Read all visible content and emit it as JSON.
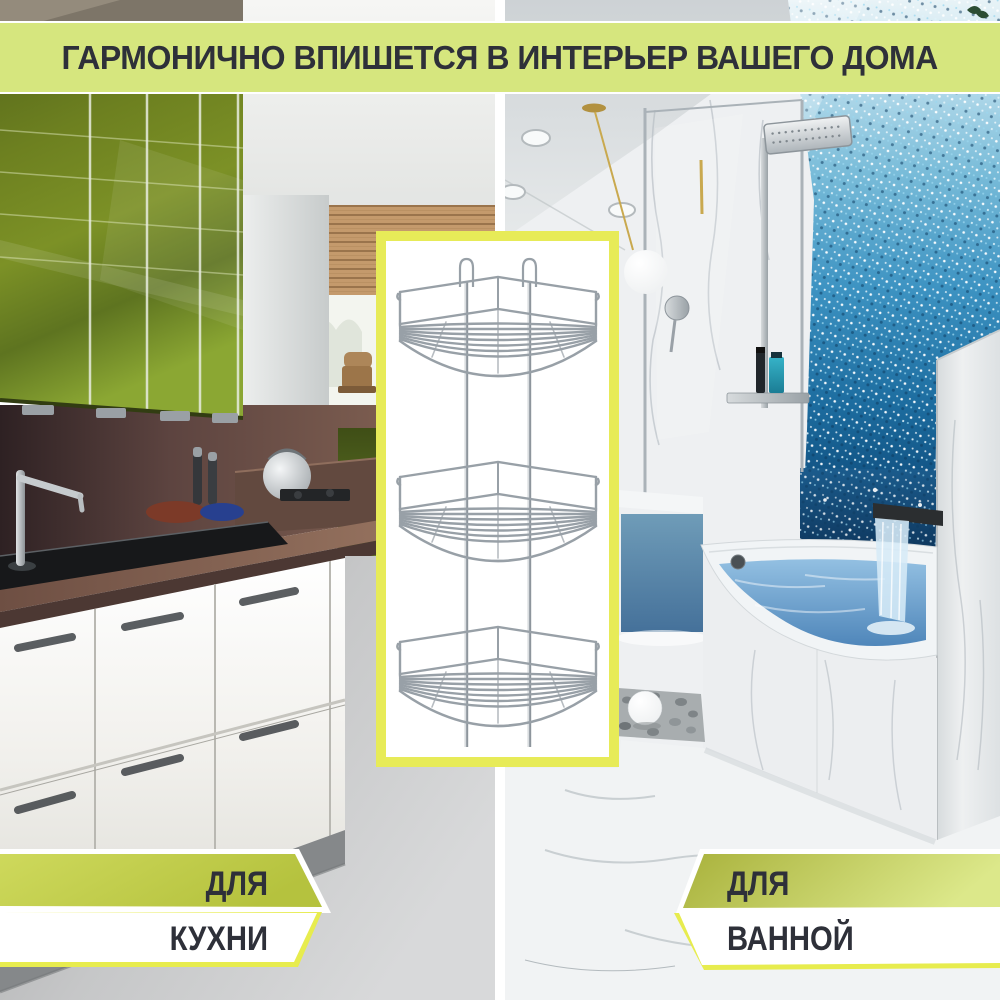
{
  "canvas": {
    "width": 1000,
    "height": 1000
  },
  "banner": {
    "title": "ГАРМОНИЧНО ВПИШЕТСЯ В ИНТЕРЬЕР ВАШЕГО ДОМА",
    "bg_color": "#d6e67e",
    "text_color": "#2e3039",
    "border_color": "#ffffff"
  },
  "product_frame": {
    "border_color": "#e7eb58",
    "bg_color": "#ffffff",
    "item": "three-tier-corner-wire-shelf",
    "chrome_color": "#98a0a7"
  },
  "ribbon_kitchen": {
    "line1": "ДЛЯ",
    "line2": "КУХНИ",
    "band1_color": "#c3cf4e",
    "band2_color": "#ffffff",
    "outline_color": "#e7ec4e",
    "text_color": "#2e3039"
  },
  "ribbon_bathroom": {
    "line1": "ДЛЯ",
    "line2": "ВАННОЙ",
    "band1_color": "#b9c342",
    "band2_color": "#ffffff",
    "outline_color": "#e7ec4e",
    "text_color": "#2e3039"
  },
  "scenes": {
    "left": "kitchen-interior",
    "right": "bathroom-interior",
    "divider_color": "#ffffff"
  }
}
